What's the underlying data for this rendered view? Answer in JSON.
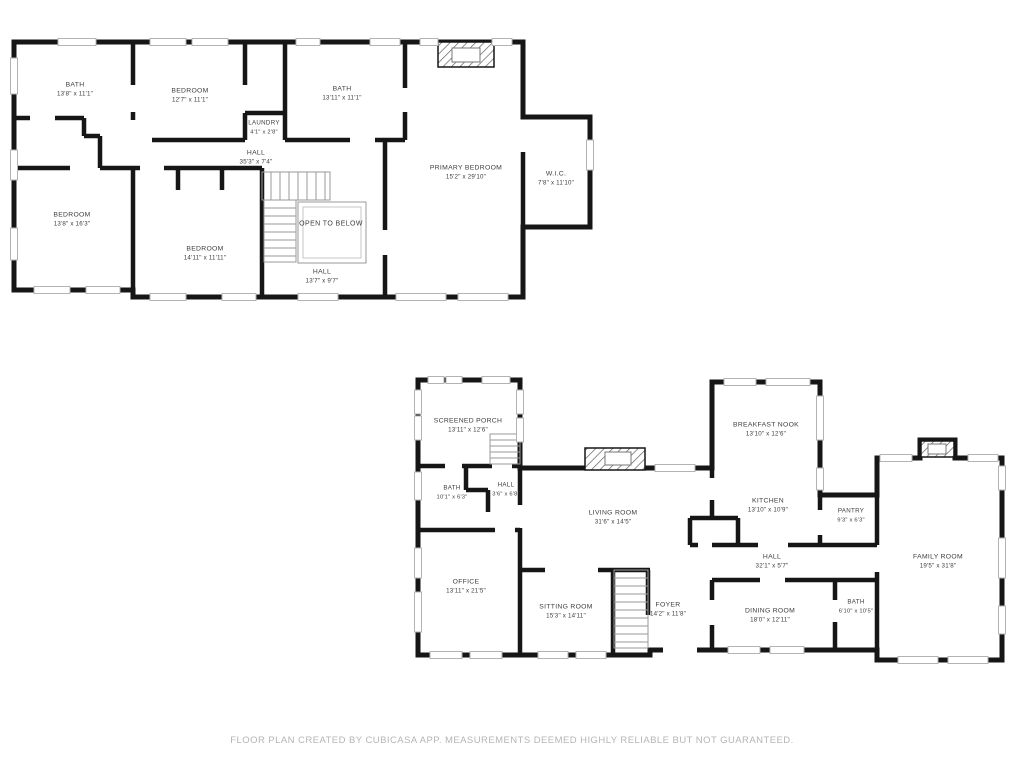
{
  "page": {
    "background": "#ffffff"
  },
  "colors": {
    "wall": "#161616",
    "window_line": "#b3b3b3",
    "stair_line": "#9a9a9a",
    "label_text": "#3d3d3d",
    "footer_text": "#b5b5b5"
  },
  "footer": {
    "text": "FLOOR PLAN CREATED BY CUBICASA APP. MEASUREMENTS DEEMED HIGHLY RELIABLE BUT NOT GUARANTEED."
  },
  "floors": [
    {
      "name": "Upper Floor",
      "rooms": [
        {
          "label": "BATH",
          "dims": "13'8\" x 11'1\""
        },
        {
          "label": "BEDROOM",
          "dims": "12'7\" x 11'1\""
        },
        {
          "label": "BATH",
          "dims": "13'11\" x 11'1\""
        },
        {
          "label": "LAUNDRY",
          "dims": "4'1\" x 2'8\""
        },
        {
          "label": "HALL",
          "dims": "35'3\" x 7'4\""
        },
        {
          "label": "PRIMARY BEDROOM",
          "dims": "15'2\" x 29'10\""
        },
        {
          "label": "W.I.C.",
          "dims": "7'8\" x 11'10\""
        },
        {
          "label": "BEDROOM",
          "dims": "13'8\" x 16'3\""
        },
        {
          "label": "BEDROOM",
          "dims": "14'11\" x 11'11\""
        },
        {
          "label": "HALL",
          "dims": "13'7\" x 9'7\""
        }
      ],
      "annotations": [
        {
          "label": "OPEN TO BELOW"
        }
      ]
    },
    {
      "name": "Main Floor",
      "rooms": [
        {
          "label": "SCREENED PORCH",
          "dims": "13'11\" x 12'6\""
        },
        {
          "label": "BATH",
          "dims": "10'1\" x 6'3\""
        },
        {
          "label": "HALL",
          "dims": "3'6\" x 6'8\""
        },
        {
          "label": "LIVING ROOM",
          "dims": "31'6\" x 14'5\""
        },
        {
          "label": "BREAKFAST NOOK",
          "dims": "13'10\" x 12'6\""
        },
        {
          "label": "KITCHEN",
          "dims": "13'10\" x 10'9\""
        },
        {
          "label": "PANTRY",
          "dims": "9'3\" x 6'3\""
        },
        {
          "label": "FAMILY ROOM",
          "dims": "19'5\" x 31'8\""
        },
        {
          "label": "HALL",
          "dims": "32'1\" x 5'7\""
        },
        {
          "label": "OFFICE",
          "dims": "13'11\" x 21'5\""
        },
        {
          "label": "SITTING ROOM",
          "dims": "15'3\" x 14'11\""
        },
        {
          "label": "FOYER",
          "dims": "14'2\" x 11'8\""
        },
        {
          "label": "DINING ROOM",
          "dims": "18'0\" x 12'11\""
        },
        {
          "label": "BATH",
          "dims": "6'10\" x 10'5\""
        }
      ]
    }
  ]
}
